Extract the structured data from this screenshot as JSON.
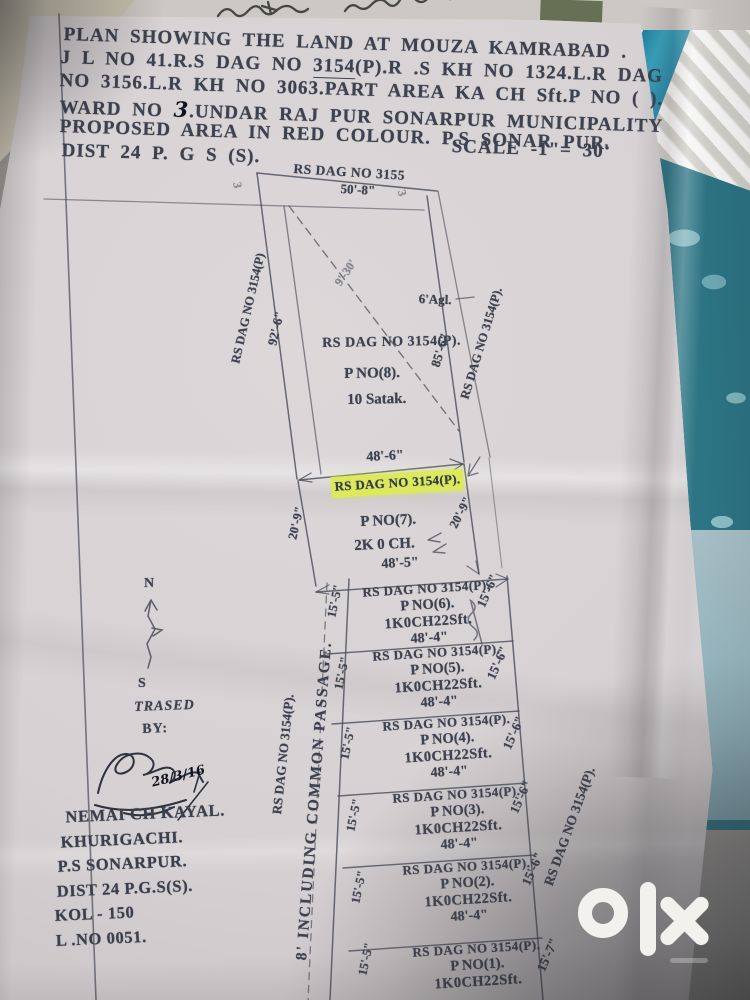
{
  "header": {
    "line1": "PLAN SHOWING THE LAND AT MOUZA KAMRABAD .",
    "line2_pre": "J L NO 41.R.S DAG NO ",
    "line2_dag": "3154",
    "line2_post": "(P).R .S KH NO 1324.L.R DAG",
    "line3": "NO 3156.L.R KH NO 3063.PART AREA  KA  CH Sft.P NO ( ).",
    "line4_pre": "WARD NO ",
    "line4_ward": "3",
    "line4_post": ".UNDAR RAJ PUR SONARPUR MUNICIPALITY",
    "line5": "PROPOSED AREA IN RED  COLOUR.  P.S SONAR PUR.",
    "line6": "DIST 24 P. G S (S).",
    "scale": "SCALE -1\"= 30'"
  },
  "plan": {
    "top_dag": "RS DAG NO 3155",
    "top_dim": "50'-8\"",
    "corner_marks": [
      "3",
      "3"
    ],
    "left_outer_dag": "RS DAG NO 3154(P)",
    "left_dim": "92'-6\"",
    "diag_dim": "9'-30'",
    "agl": "6'Agl.",
    "right_dim": "85'-6\"",
    "right_outer_dag": "RS DAG NO 3154(P).",
    "plot8": {
      "dag": "RS DAG NO 3154(P).",
      "pno": "P  NO(8).",
      "area": "10 Satak."
    },
    "dim_top7": "48'-6\"",
    "highlighted_dag": "RS DAG NO 3154(P).",
    "plot7": {
      "pno": "P  NO(7).",
      "area": "2K 0 CH.",
      "left_dim": "20'-9\"",
      "right_dim": "20'-9\""
    },
    "dim_bottom7": "48'-5\"",
    "passage": "8' INCLUDING COMMON  PASSAGE.",
    "passage_dag": "RS DAG NO 3154(P).",
    "right_col_dag": "RS DAG NO 3154(P).",
    "rows": [
      {
        "dag": "RS DAG NO 3154(P).",
        "pno": "P  NO(6).",
        "area": "1K0CH22Sft.",
        "dim": "48'-4\"",
        "left": "15'-5\"",
        "right": "15'-6\""
      },
      {
        "dag": "RS DAG NO 3154(P).",
        "pno": "P  NO(5).",
        "area": "1K0CH22Sft.",
        "dim": "48'-4\"",
        "left": "15'-5\"",
        "right": "15'-6\""
      },
      {
        "dag": "RS DAG NO 3154(P).",
        "pno": "P  NO(4).",
        "area": "1K0CH22Sft.",
        "dim": "48'-4\"",
        "left": "15'-5\"",
        "right": "15'-6\""
      },
      {
        "dag": "RS DAG NO 3154(P).",
        "pno": "P  NO(3).",
        "area": "1K0CH22Sft.",
        "dim": "48'-4\"",
        "left": "15'-5\"",
        "right": "15'-6\""
      },
      {
        "dag": "RS DAG NO 3154(P).",
        "pno": "P  NO(2).",
        "area": "1K0CH22Sft.",
        "dim": "48'-4\"",
        "left": "15'-5\"",
        "right": "15'-6\""
      },
      {
        "dag": "RS DAG NO 3154(P).",
        "pno": "P  NO(1).",
        "area": "1K0CH22Sft.",
        "left": "15'-5\"",
        "right": "15'-7\""
      }
    ]
  },
  "compass": {
    "north": "N",
    "south": "S"
  },
  "tracer": {
    "trased": "TRASED",
    "by": "BY:",
    "date": "28/3/16",
    "name": "NEMAI CH KAYAL.",
    "address1": "KHURIGACHI.",
    "address2": "P.S SONARPUR.",
    "address3": "DIST 24 P.G.S(S).",
    "address4": "KOL - 150",
    "address5": "L .NO 0051."
  },
  "watermark": {
    "brand": "olx"
  },
  "colors": {
    "highlight": "#dce95c",
    "fabric": "#2d7585",
    "ink": "#3d4250",
    "paper": "#d6d2d3"
  }
}
